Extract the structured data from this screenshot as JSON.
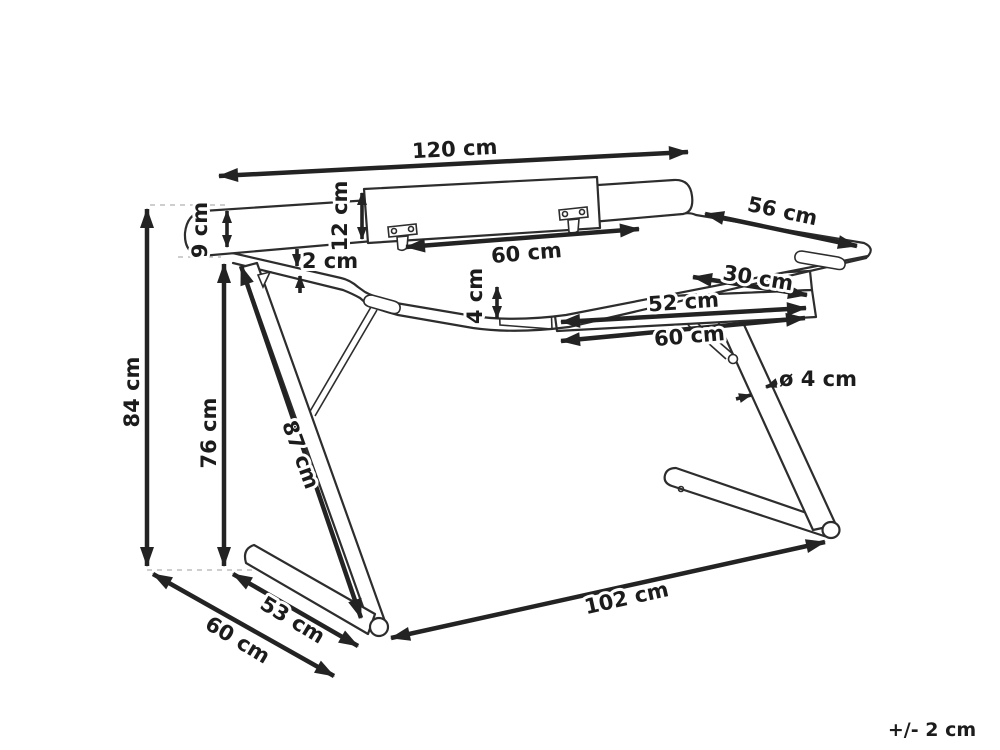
{
  "diagram": {
    "kind": "desk dimension drawing",
    "dims": {
      "total_width": "120 cm",
      "back_rail_height": "9 cm",
      "riser_height": "12 cm",
      "riser_width": "60 cm",
      "top_thickness": "2 cm",
      "total_depth": "56 cm",
      "tray_depth": "30 cm",
      "tray_front_width": "52 cm",
      "tray_total_width": "60 cm",
      "tray_height": "4 cm",
      "total_height": "84 cm",
      "clearance_height": "76 cm",
      "leg_length": "87 cm",
      "tube_diameter": "ø 4 cm",
      "base_span": "102 cm",
      "foot_length": "53 cm",
      "base_side_depth": "60 cm",
      "tolerance": "+/- 2 cm"
    }
  }
}
